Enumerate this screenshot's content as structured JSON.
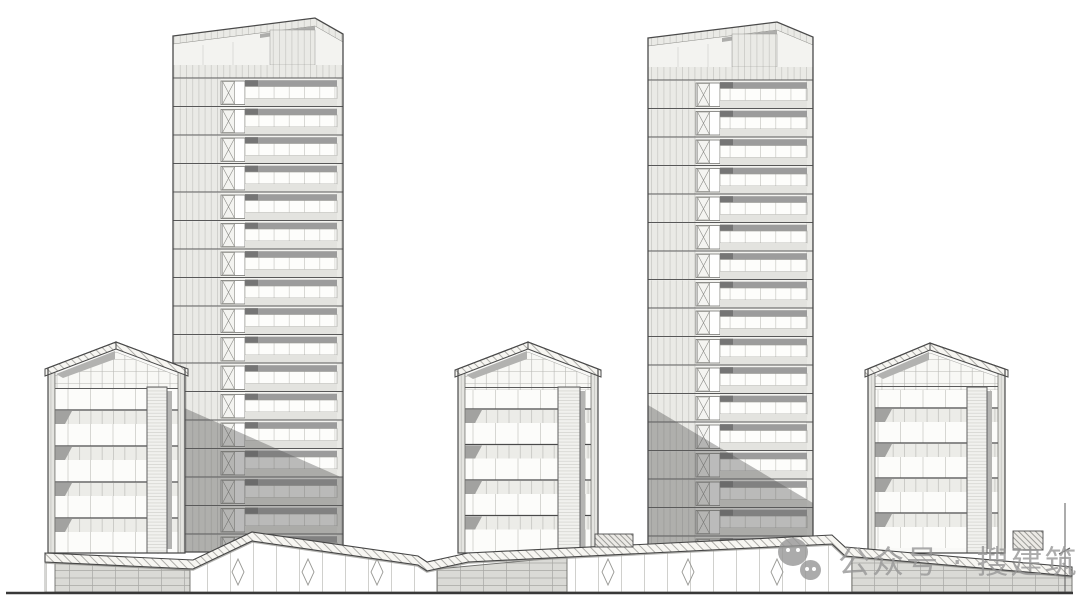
{
  "watermark": {
    "text": "公众号 · 搜建筑",
    "icon": "wechat-icon",
    "color": "#979797"
  },
  "colors": {
    "background": "#ffffff",
    "outline": "#4a4a4a",
    "body_fill": "#f3f3f0",
    "lowrise_fill": "#f9f9f7",
    "lintel": "#9c9c9c",
    "lintel_dark": "#757575",
    "sill": "#e3e3df",
    "shadow": "rgba(92,92,92,0.42)",
    "roof_shade": "#b2b2b0",
    "wedge": "#a2a2a0",
    "core_shadow": "#b5b5b3",
    "ground": "#383838",
    "canopy_shadow": "#9a9a96"
  },
  "elevation": {
    "ground": {
      "x1": 6,
      "x2": 1073,
      "y": 593
    },
    "dimension_marker": {
      "x": 1065,
      "y1": 503,
      "y2": 592,
      "tick_y": 551
    },
    "towers": [
      {
        "name": "tower-left",
        "x": 173,
        "width": 170,
        "top_left_y": 36,
        "peak_dx": 142,
        "peak_y": 18,
        "top_right_y": 34,
        "mech_top": 65,
        "floors_top": 78,
        "floor_height": 28.5,
        "floor_count": 17,
        "bottom": 552,
        "shadow": [
          [
            173,
            403
          ],
          [
            343,
            478
          ],
          [
            343,
            552
          ],
          [
            173,
            552
          ]
        ]
      },
      {
        "name": "tower-right",
        "x": 648,
        "width": 165,
        "top_left_y": 38,
        "peak_dx": 129,
        "peak_y": 22,
        "top_right_y": 37,
        "mech_top": 67,
        "floors_top": 80,
        "floor_height": 28.5,
        "floor_count": 17,
        "bottom": 552,
        "shadow": [
          [
            648,
            405
          ],
          [
            813,
            503
          ],
          [
            813,
            552
          ],
          [
            648,
            552
          ]
        ]
      }
    ],
    "lowrises": [
      {
        "name": "lowrise-left",
        "x": 48,
        "width": 137,
        "peak_dx": 68,
        "peak_y": 342,
        "eave_y": 368,
        "band_top": 389,
        "floors_top": 410,
        "floor_height": 36,
        "floor_count": 4,
        "bottom": 553,
        "core_dx": 99,
        "core_w": 20
      },
      {
        "name": "lowrise-center",
        "x": 458,
        "width": 140,
        "peak_dx": 70,
        "peak_y": 342,
        "eave_y": 369,
        "band_top": 390,
        "floors_top": 409,
        "floor_height": 35.5,
        "floor_count": 4,
        "bottom": 553,
        "core_dx": 100,
        "core_w": 22
      },
      {
        "name": "lowrise-right",
        "x": 868,
        "width": 137,
        "peak_dx": 62,
        "peak_y": 343,
        "eave_y": 369,
        "band_top": 390,
        "floors_top": 408,
        "floor_height": 35,
        "floor_count": 4,
        "bottom": 553,
        "core_dx": 99,
        "core_w": 20
      }
    ],
    "podium": {
      "canopy_top_path": [
        [
          45,
          553
        ],
        [
          193,
          560
        ],
        [
          252,
          532
        ],
        [
          418,
          556
        ],
        [
          427,
          562
        ],
        [
          468,
          553
        ],
        [
          832,
          535
        ],
        [
          845,
          547
        ],
        [
          1072,
          567
        ]
      ],
      "canopy_thickness": 9,
      "glass_wall": {
        "x1": 45,
        "x2": 1072,
        "bottom": 592,
        "brace_xs": [
          238,
          308,
          377,
          608,
          688,
          777
        ]
      },
      "grid_walls": [
        [
          [
            55,
            563
          ],
          [
            190,
            570
          ],
          [
            190,
            592
          ],
          [
            55,
            592
          ]
        ],
        [
          [
            437,
            569
          ],
          [
            567,
            557
          ],
          [
            567,
            592
          ],
          [
            437,
            592
          ]
        ],
        [
          [
            852,
            557
          ],
          [
            1072,
            577
          ],
          [
            1072,
            592
          ],
          [
            852,
            592
          ]
        ]
      ],
      "roof_blocks": [
        [
          595,
          534,
          38,
          13
        ],
        [
          1013,
          531,
          30,
          19
        ]
      ]
    }
  }
}
